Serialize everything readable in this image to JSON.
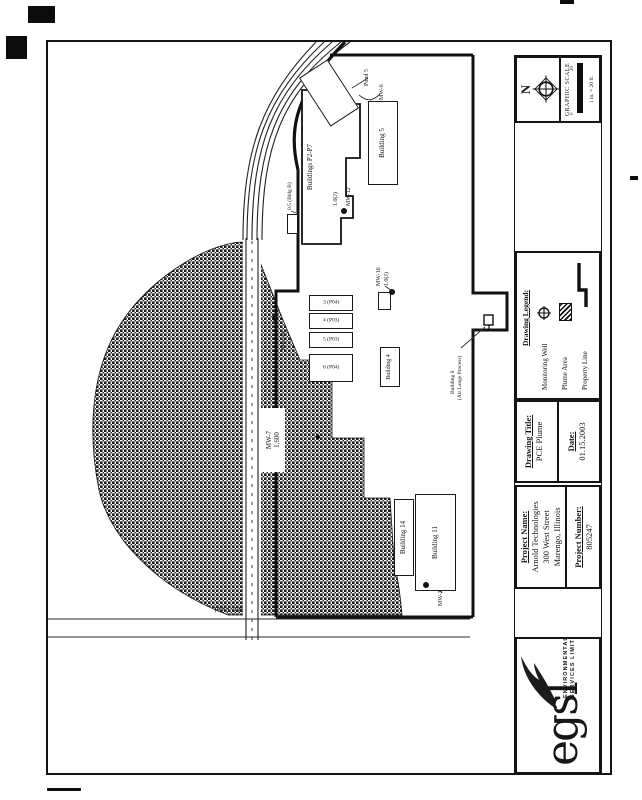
{
  "title_block": {
    "logo": {
      "text": "egsl",
      "tagline_line1": "ENVIRONMENTAL GROUP",
      "tagline_line2": "SERVICES LIMITED"
    },
    "project": {
      "name_heading": "Project Name:",
      "name_line1": "Arnold Technologies",
      "name_line2": "300 West Street",
      "name_line3": "Marengo, Illinois",
      "number_heading": "Project Number:",
      "number": "805247"
    },
    "drawing_title": {
      "heading": "Drawing Title:",
      "value": "PCE Plume"
    },
    "date": {
      "heading": "Date:",
      "value": "01.15.2003"
    },
    "legend": {
      "heading": "Drawing Legend:",
      "items": [
        {
          "label": "Monitoring Well"
        },
        {
          "label": "Plume Area"
        },
        {
          "label": "Property Line"
        }
      ]
    },
    "north_label": "N",
    "scale": {
      "heading": "GRAPHIC SCALE",
      "tick_left": "0",
      "tick_right": "20",
      "note": "1 in. = 20 ft."
    }
  },
  "plan": {
    "road_label": "Ritz Road",
    "buildings": {
      "factory": "Buildings P2-P7",
      "building5": "Building 5",
      "building4": "Building 4",
      "building14": "Building 14",
      "building11": "Building 11",
      "bldg_b": "0.5 (Bldg B)",
      "tanks": [
        "6 (P04)",
        "5 (P03)",
        "4 (P03)",
        "3 (P04)"
      ]
    },
    "wells": {
      "mw10": "MW-10",
      "mw12": "MW-12",
      "mw12_value": "1.0(J)",
      "mw16": "MW-16",
      "mw16_value": "1.0(J)",
      "mw3": "MW-3",
      "mw6": "MW-6"
    },
    "callouts": {
      "pond": "Pond 5",
      "building8_line1": "Building 8",
      "building8_line2": "(Air Lange Process)",
      "plume_line1": "MW-7",
      "plume_line2": "1,600"
    }
  }
}
